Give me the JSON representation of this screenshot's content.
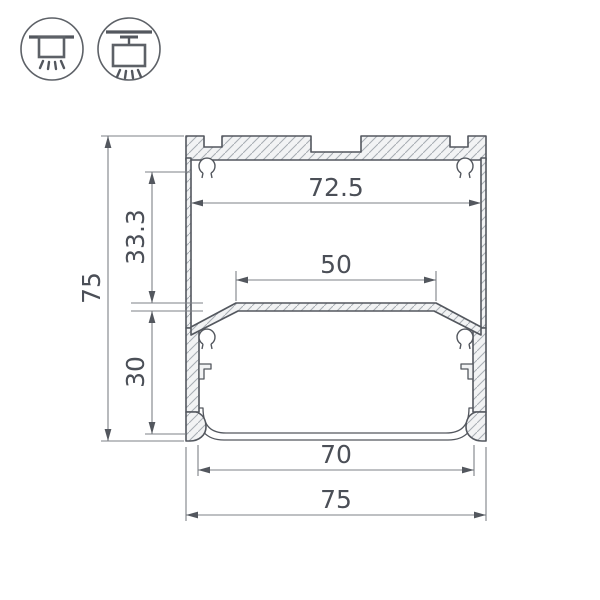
{
  "icons": {
    "surface_mount": {
      "name": "surface-mount-luminaire-icon"
    },
    "pendant_mount": {
      "name": "pendant-mount-luminaire-icon"
    }
  },
  "drawing": {
    "dimensions": {
      "overall_height": "75",
      "inner_top_width": "72.5",
      "upper_chamber_height": "33.3",
      "led_platform_width": "50",
      "lower_chamber_height": "30",
      "bottom_opening_width": "70",
      "overall_width": "75"
    },
    "colors": {
      "outline": "#53575e",
      "dimension_line": "#7d8187",
      "text": "#4b4f57",
      "hatch": "#a7acb2",
      "metal_fill": "#f2f3f4",
      "background": "#ffffff"
    }
  }
}
